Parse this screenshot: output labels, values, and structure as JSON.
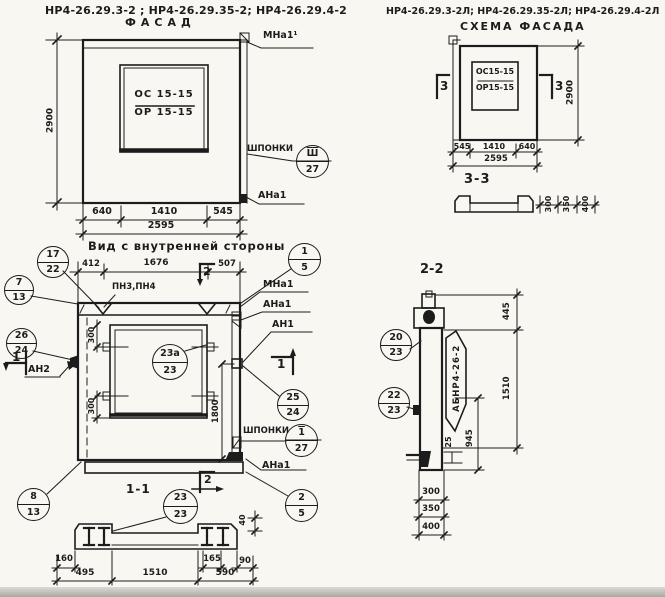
{
  "titles": {
    "marks_left": "НР4-26.29.3-2 ; НР4-26.29.35-2; НР4-26.29.4-2",
    "facade": "ФАСАД",
    "marks_right": "НР4-26.29.3-2Л; НР4-26.29.35-2Л; НР4-26.29.4-2Л",
    "schema": "СХЕМА ФАСАДА",
    "inner_view": "Вид с внутренней стороны",
    "section_1_1": "1-1",
    "section_2_2": "2-2",
    "section_3_3": "3-3"
  },
  "facade": {
    "window_top": "ОС 15-15",
    "window_bottom": "ОР 15-15",
    "dim_height": "2900",
    "dim_left": "640",
    "dim_mid": "1410",
    "dim_right": "545",
    "dim_total": "2595",
    "label_mna1": "МНа1¹",
    "label_shponki": "ШПОНКИ",
    "callout_shponki": {
      "top": "Ш",
      "bottom": "27"
    },
    "label_ana1": "АНа1"
  },
  "schema": {
    "window_top": "ОС15-15",
    "window_bottom": "ОР15-15",
    "dim_height": "2900",
    "dim_left": "545",
    "dim_mid": "1410",
    "dim_right": "640",
    "dim_total": "2595",
    "marker_left": "3",
    "marker_right": "3",
    "s33_dims": {
      "d300": "300",
      "d350": "350",
      "d400": "400"
    }
  },
  "inner": {
    "dim_412": "412",
    "dim_1676": "1676",
    "dim_507": "507",
    "marker_top": "2",
    "marker_bottom": "2",
    "marker_left": "1",
    "marker_right": "1",
    "label_pn": "ПН3,ПН4",
    "label_mna1": "МНа1",
    "label_ana1": "АНа1",
    "label_an1": "АН1",
    "label_an2": "АН2",
    "label_shponki": "ШПОНКИ",
    "label_ana1_bottom": "АНа1",
    "dim_300_top": "300",
    "dim_300_bottom": "300",
    "dim_1800": "1800",
    "callouts": {
      "c17": {
        "top": "17",
        "bottom": "22"
      },
      "c7": {
        "top": "7",
        "bottom": "13"
      },
      "c26": {
        "top": "26",
        "bottom": "24"
      },
      "c1_5": {
        "top": "1",
        "bottom": "5"
      },
      "c23a": {
        "top": "23а",
        "bottom": "23"
      },
      "c25": {
        "top": "25",
        "bottom": "24"
      },
      "c_sh": {
        "top": "1",
        "bottom": "27"
      },
      "c8": {
        "top": "8",
        "bottom": "13"
      },
      "c2_5": {
        "top": "2",
        "bottom": "5"
      }
    }
  },
  "s11": {
    "callout": {
      "top": "23",
      "bottom": "23"
    },
    "dims": {
      "d160": "160",
      "d495": "495",
      "d1510": "1510",
      "d165": "165",
      "d90": "90",
      "d590": "590",
      "d40": "40"
    }
  },
  "s22": {
    "flag": "АБНР4-26-2",
    "callouts": {
      "c20": {
        "top": "20",
        "bottom": "23"
      },
      "c22": {
        "top": "22",
        "bottom": "23"
      }
    },
    "dims": {
      "d445": "445",
      "d1510": "1510",
      "d945": "945",
      "d25": "25",
      "d300": "300",
      "d350": "350",
      "d400": "400"
    }
  }
}
